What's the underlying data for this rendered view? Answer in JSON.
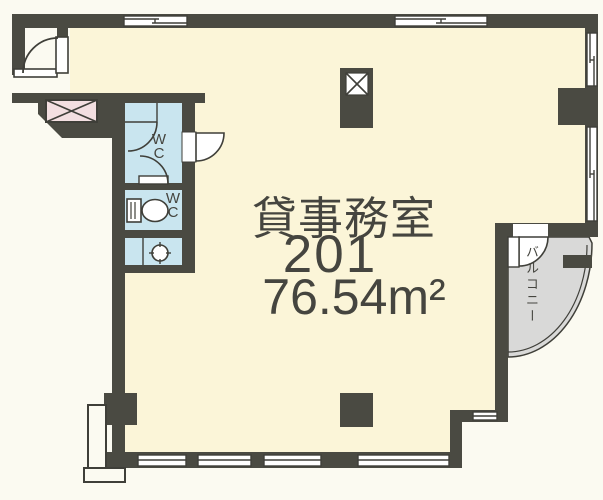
{
  "unit": {
    "type_label": "貸事務室",
    "number": "201",
    "area": "76.54m²"
  },
  "rooms": {
    "wc_upper_label": "WC",
    "wc_lower_label": "WC"
  },
  "balcony": {
    "label": "バルコニー"
  },
  "colors": {
    "wall": "#4a4a42",
    "line": "#3f3f39",
    "room_fill": "#fbf5d8",
    "wc_fill": "#c9e5ef",
    "elevator_fill": "#f3dfe1",
    "balcony_fill": "#d9d9d8",
    "text": "#45453f",
    "background": "#fbfaf1"
  }
}
